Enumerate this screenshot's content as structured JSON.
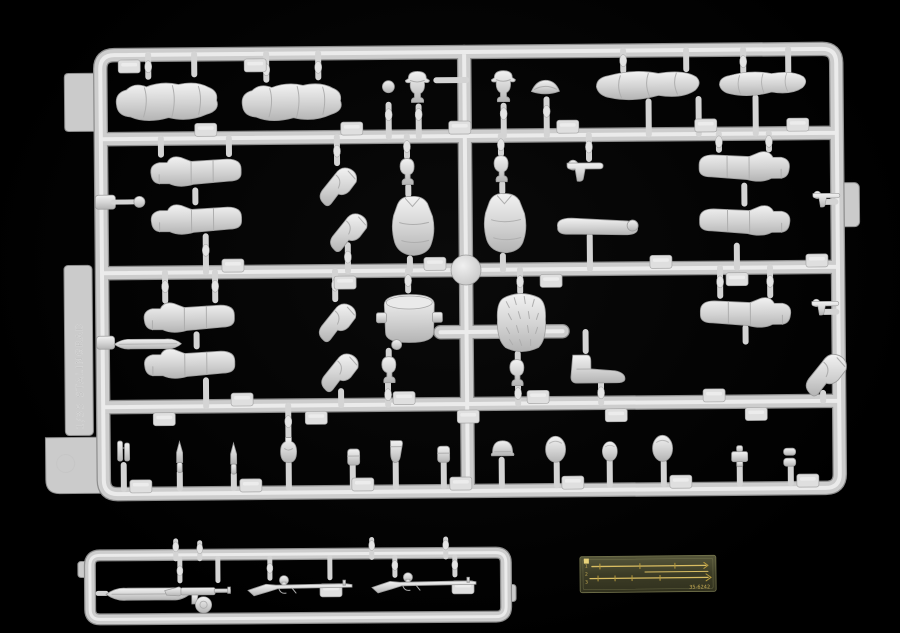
{
  "scene": {
    "type": "photograph",
    "description": "Light-gray injection-molded styrene sprues of a 1/35 scale figure model kit, with a small brass photo-etched fret, photographed on a black background",
    "background_color": "#000000",
    "plastic_color": "#d6d6d6"
  },
  "main_sprue": {
    "label": "main figure-parts sprue",
    "molded_marking": "1/35 STALINGRAD",
    "rows": [
      {
        "name": "top row",
        "parts": [
          "prone greatcoat body",
          "prone greatcoat body",
          "hand",
          "head with field cap",
          "head with visor cap",
          "side cap",
          "rolled greatcoat",
          "rolled greatcoat"
        ]
      },
      {
        "name": "second row",
        "parts": [
          "leg with boot",
          "leg with boot",
          "valve fitting",
          "bent arm",
          "bent arm",
          "head",
          "torso",
          "head",
          "torso",
          "pistol in hand",
          "straight arm",
          "leg with boot",
          "leg with boot",
          "holstered pistol"
        ]
      },
      {
        "name": "third row",
        "parts": [
          "leg with boot",
          "leg with boot",
          "flask",
          "bent arm",
          "bent arm",
          "pack drum",
          "head",
          "fur backpack",
          "head",
          "ankle boot",
          "leg with boot",
          "bent arm",
          "holstered pistol"
        ]
      },
      {
        "name": "bottom row",
        "parts": [
          "binoculars",
          "bayonet",
          "bayonet",
          "flat canteen",
          "ammo pouch",
          "holster",
          "ammo pouch",
          "steel helmet",
          "helmet dome",
          "small helmet dome",
          "helmet dome",
          "belt buckle",
          "stacked lids"
        ]
      }
    ]
  },
  "weapons_sprue": {
    "label": "weapons sprue",
    "parts": [
      "pointed magazine",
      "submachine gun with drum magazine",
      "scoped rifle",
      "scoped rifle"
    ]
  },
  "etched_fret": {
    "label": "photo-etched brass fret",
    "base_color": "#3c3c26",
    "line_color": "#d9bd62",
    "marking": "35-6242",
    "edge_numbers": [
      "1",
      "2",
      "3"
    ],
    "contents": [
      "rifle sling",
      "rifle sling",
      "short strap"
    ]
  }
}
